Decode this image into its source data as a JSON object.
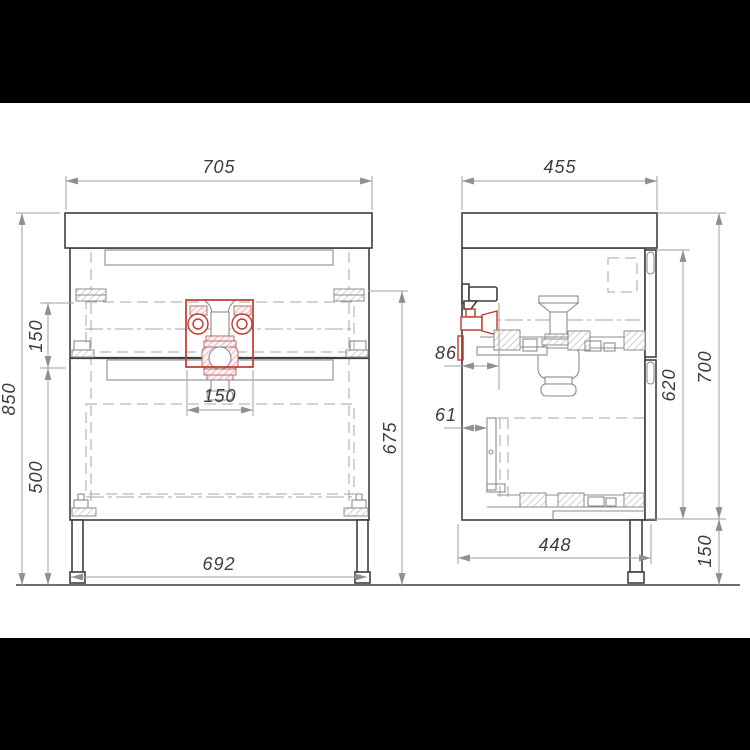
{
  "colors": {
    "background": "#ffffff",
    "matte": "#000000",
    "outline": "#3f3f3f",
    "detail": "#8c8c8c",
    "dimension": "#9f9f9f",
    "label": "#3c3c3c",
    "highlight": "#c0392b"
  },
  "dimensions": {
    "front_view": {
      "overall_width": "705",
      "overall_height": "850",
      "drawer_offset": "150",
      "lower_section": "500",
      "carcass_height": "675",
      "drain_width": "150",
      "leg_span": "692"
    },
    "side_view": {
      "overall_depth": "455",
      "valve_offset": "86",
      "runner_offset": "61",
      "inner_height": "620",
      "cabinet_height": "700",
      "leg_height": "150",
      "base_depth": "448"
    }
  }
}
